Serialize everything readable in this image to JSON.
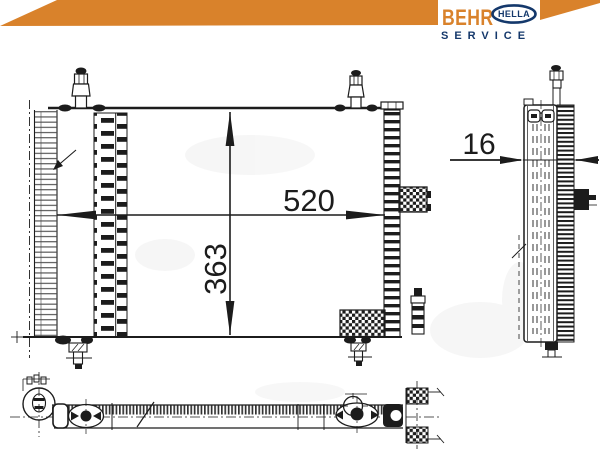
{
  "brand": {
    "behr": "BEHR",
    "hella": "HELLA",
    "service": "SERVICE"
  },
  "colors": {
    "brand_orange": "#D9822B",
    "brand_navy": "#14386B",
    "line": "#1c1c1c",
    "paper": "#FFFFFF"
  },
  "drawing": {
    "dim_width": "520",
    "dim_height": "363",
    "dim_depth": "16"
  }
}
